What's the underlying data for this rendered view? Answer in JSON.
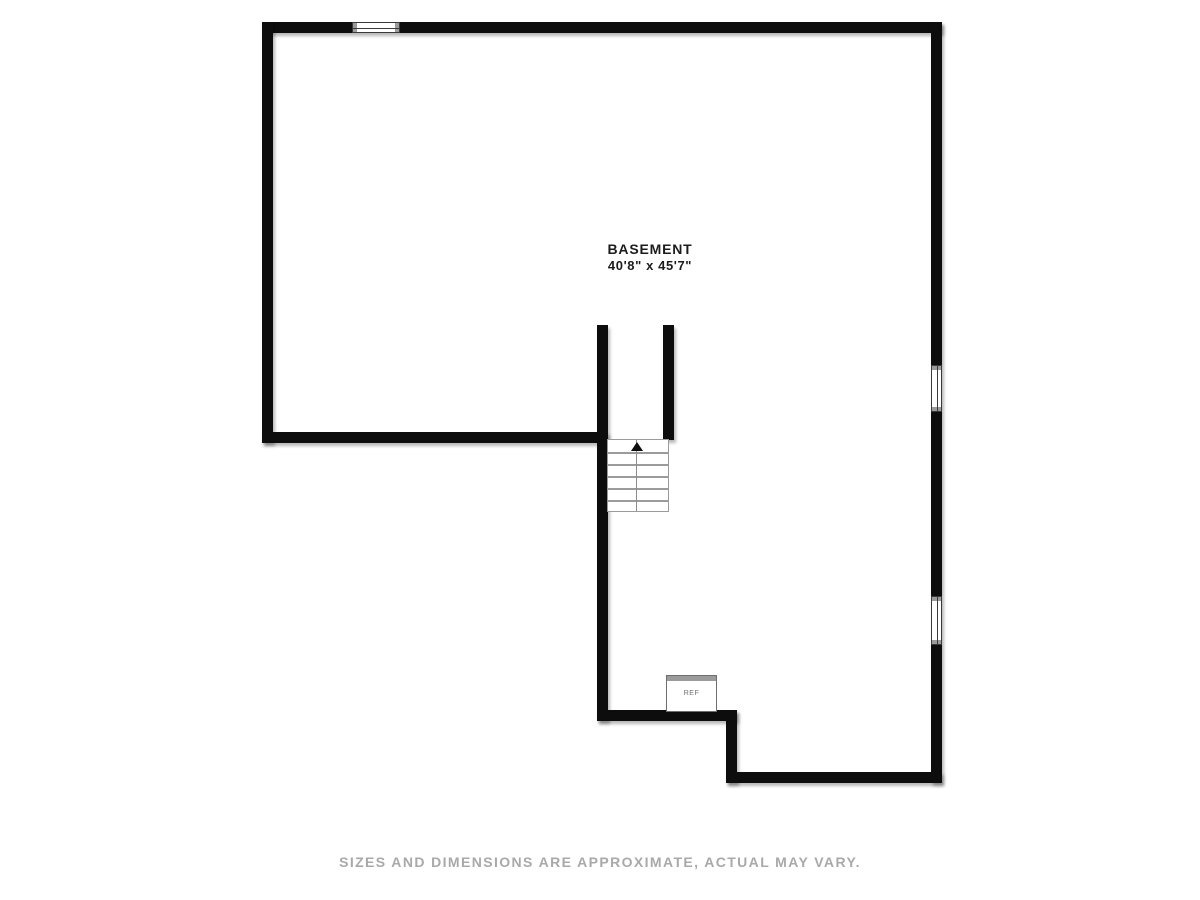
{
  "plan": {
    "room_name": "BASEMENT",
    "room_dimensions": "40'8\" x 45'7\"",
    "appliance_label": "REF",
    "stairs_direction": "up"
  },
  "footer": {
    "disclaimer": "SIZES AND DIMENSIONS ARE APPROXIMATE, ACTUAL MAY VARY."
  },
  "colors": {
    "wall": "#0d0d0d",
    "stair_lines": "#9b9b9b",
    "appliance_top": "#9b9b9b",
    "label_text": "#1c1c1c",
    "disclaimer_text": "#a9a9a9",
    "background": "#ffffff"
  }
}
